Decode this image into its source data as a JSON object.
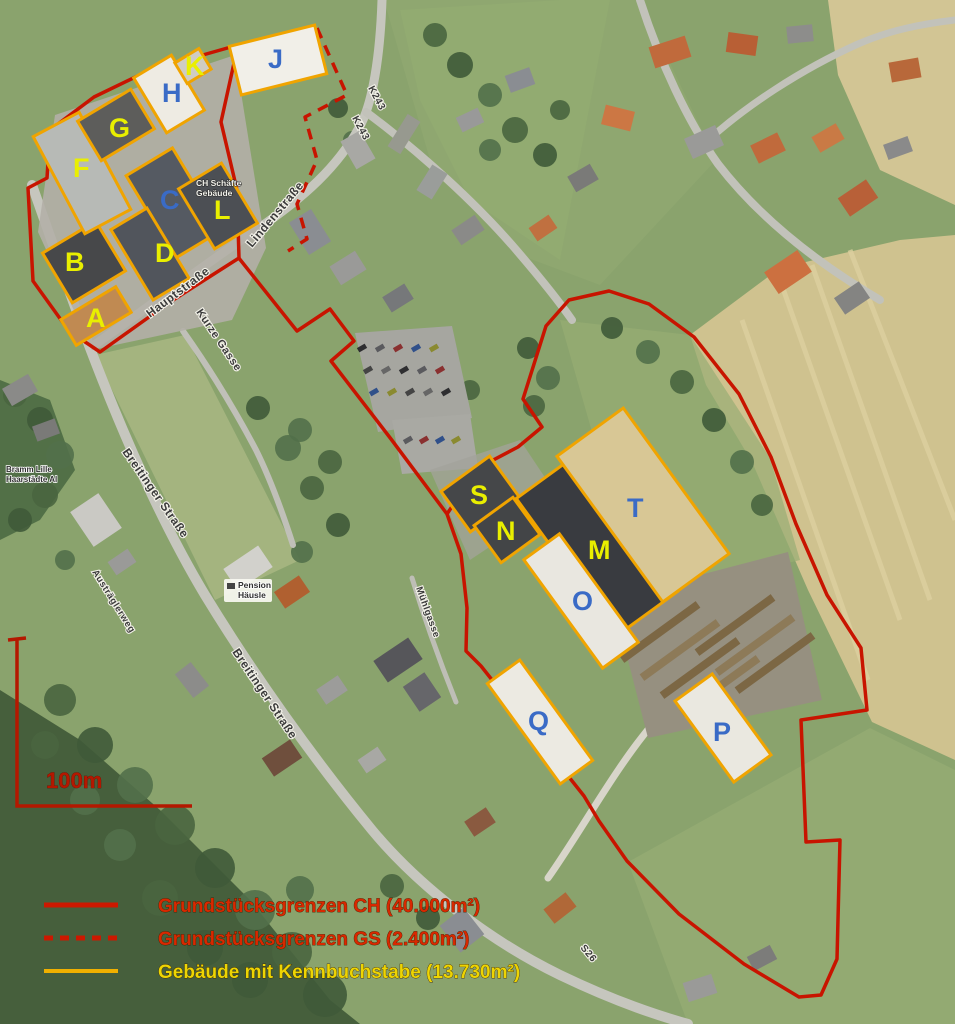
{
  "scale": {
    "label": "100m"
  },
  "legend": {
    "items": [
      {
        "label": "Grundstücksgrenzen CH (40.000m²)",
        "color": "#d82800",
        "swatch_color": "#cc1800",
        "swatch_style": "solid"
      },
      {
        "label": "Grundstücksgrenzen GS (2.400m²)",
        "color": "#d82800",
        "swatch_color": "#cc1800",
        "swatch_style": "dashed"
      },
      {
        "label": "Gebäude mit Kennbuchstabe (13.730m²)",
        "color": "#edd503",
        "swatch_color": "#f0b000",
        "swatch_style": "solid"
      }
    ]
  },
  "map": {
    "colors": {
      "boundary_red": "#c81400",
      "building_outline": "#f0a400",
      "label_yellow": "#e9ef00",
      "label_blue": "#3a6bc6"
    },
    "buildings": [
      {
        "letter": "A",
        "lx": 86,
        "ly": 327,
        "lc": "#e9ef00",
        "cx": 96,
        "cy": 316,
        "w": 64,
        "h": 30,
        "rot": -31,
        "roof": "#c08a52"
      },
      {
        "letter": "B",
        "lx": 65,
        "ly": 271,
        "lc": "#e9ef00",
        "cx": 84,
        "cy": 262,
        "w": 62,
        "h": 58,
        "rot": -31,
        "roof": "#47484a"
      },
      {
        "letter": "C",
        "lx": 160,
        "ly": 209,
        "lc": "#3a6bc6",
        "cx": 174,
        "cy": 203,
        "w": 54,
        "h": 96,
        "rot": -31,
        "roof": "#555a62"
      },
      {
        "letter": "D",
        "lx": 155,
        "ly": 262,
        "lc": "#e9ef00",
        "cx": 150,
        "cy": 254,
        "w": 42,
        "h": 82,
        "rot": -31,
        "roof": "#51555c"
      },
      {
        "letter": "F",
        "lx": 73,
        "ly": 177,
        "lc": "#e9ef00",
        "cx": 82,
        "cy": 173,
        "w": 52,
        "h": 110,
        "rot": -28,
        "roof": "#b7bab6"
      },
      {
        "letter": "G",
        "lx": 109,
        "ly": 137,
        "lc": "#e9ef00",
        "cx": 116,
        "cy": 125,
        "w": 62,
        "h": 46,
        "rot": -31,
        "roof": "#5d5d5b"
      },
      {
        "letter": "H",
        "lx": 162,
        "ly": 102,
        "lc": "#3a6bc6",
        "cx": 169,
        "cy": 94,
        "w": 44,
        "h": 64,
        "rot": -31,
        "roof": "#eeebe3"
      },
      {
        "letter": "J",
        "lx": 268,
        "ly": 68,
        "lc": "#3a6bc6",
        "cx": 278,
        "cy": 60,
        "w": 88,
        "h": 50,
        "rot": -14,
        "roof": "#f1efe8"
      },
      {
        "letter": "K",
        "lx": 185,
        "ly": 75,
        "lc": "#e9ef00",
        "cx": 193,
        "cy": 66,
        "w": 28,
        "h": 24,
        "rot": -31,
        "roof": "#cfccc3"
      },
      {
        "letter": "L",
        "lx": 214,
        "ly": 219,
        "lc": "#e9ef00",
        "cx": 218,
        "cy": 206,
        "w": 50,
        "h": 70,
        "rot": -31,
        "roof": "#4c4f54"
      },
      {
        "letter": "S",
        "lx": 470,
        "ly": 504,
        "lc": "#e9ef00",
        "cx": 480,
        "cy": 494,
        "w": 60,
        "h": 50,
        "rot": -36,
        "roof": "#454749"
      },
      {
        "letter": "N",
        "lx": 496,
        "ly": 540,
        "lc": "#e9ef00",
        "cx": 507,
        "cy": 530,
        "w": 48,
        "h": 46,
        "rot": -36,
        "roof": "#434547"
      },
      {
        "letter": "M",
        "lx": 588,
        "ly": 559,
        "lc": "#e9ef00",
        "cx": 597,
        "cy": 545,
        "w": 76,
        "h": 170,
        "rot": -36,
        "roof": "#393b40"
      },
      {
        "letter": "O",
        "lx": 572,
        "ly": 610,
        "lc": "#3a6bc6",
        "cx": 581,
        "cy": 601,
        "w": 44,
        "h": 134,
        "rot": -36,
        "roof": "#e9e7e0"
      },
      {
        "letter": "T",
        "lx": 627,
        "ly": 517,
        "lc": "#3a6bc6",
        "cx": 643,
        "cy": 505,
        "w": 82,
        "h": 180,
        "rot": -36,
        "roof": "#d8c795"
      },
      {
        "letter": "Q",
        "lx": 528,
        "ly": 730,
        "lc": "#3a6bc6",
        "cx": 540,
        "cy": 722,
        "w": 40,
        "h": 124,
        "rot": -36,
        "roof": "#eceae2"
      },
      {
        "letter": "P",
        "lx": 713,
        "ly": 741,
        "lc": "#3a6bc6",
        "cx": 723,
        "cy": 728,
        "w": 46,
        "h": 100,
        "rot": -36,
        "roof": "#eae8e0"
      }
    ],
    "street_labels": [
      {
        "text": "Hauptstraße",
        "x": 150,
        "y": 318,
        "rot": -37,
        "size": 12
      },
      {
        "text": "Lindenstraße",
        "x": 252,
        "y": 248,
        "rot": -50,
        "size": 12
      },
      {
        "text": "Kurze Gasse",
        "x": 196,
        "y": 312,
        "rot": 56,
        "size": 11
      },
      {
        "text": "Breitinger Straße",
        "x": 122,
        "y": 452,
        "rot": 55,
        "size": 12
      },
      {
        "text": "Breitinger Straße",
        "x": 232,
        "y": 652,
        "rot": 56,
        "size": 12
      },
      {
        "text": "Austräglerweg",
        "x": 92,
        "y": 572,
        "rot": 58,
        "size": 9.5
      },
      {
        "text": "Mühlgasse",
        "x": 416,
        "y": 588,
        "rot": 70,
        "size": 9.5
      },
      {
        "text": "K243",
        "x": 368,
        "y": 88,
        "rot": 62,
        "size": 10
      },
      {
        "text": "K243",
        "x": 352,
        "y": 118,
        "rot": 62,
        "size": 10
      },
      {
        "text": "S26",
        "x": 580,
        "y": 948,
        "rot": 50,
        "size": 10
      }
    ],
    "poi_labels": [
      {
        "lines": [
          "CH Schäfte",
          "Gebäude"
        ],
        "x": 196,
        "y": 186,
        "size": 8.5,
        "box": false,
        "light": true
      },
      {
        "lines": [
          "Bramm Lille",
          "Haarstädte Al"
        ],
        "x": 6,
        "y": 472,
        "size": 8,
        "box": false,
        "light": false
      },
      {
        "lines": [
          "Pension",
          "Häusle"
        ],
        "x": 238,
        "y": 588,
        "size": 8.5,
        "box": true,
        "light": false
      }
    ]
  }
}
